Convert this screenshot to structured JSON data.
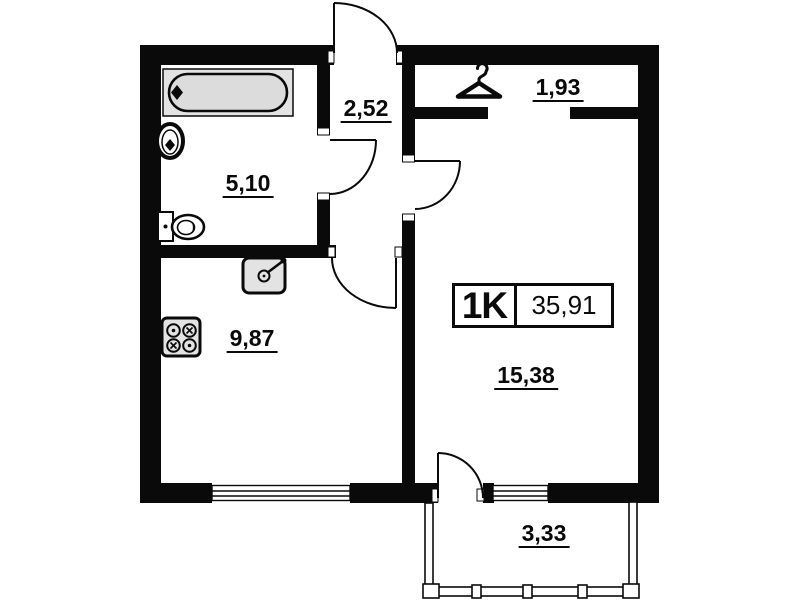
{
  "unit": {
    "type_label": "1K",
    "total_area": "35,91"
  },
  "areas": {
    "bathroom": "5,10",
    "hallway": "2,52",
    "wardrobe": "1,93",
    "kitchen": "9,87",
    "living_room": "15,38",
    "balcony": "3,33"
  },
  "icons": {
    "wardrobe": "hanger-icon",
    "bathroom": [
      "bathtub-icon",
      "washbasin-icon",
      "toilet-icon"
    ],
    "kitchen": [
      "stove-icon",
      "kitchen-sink-icon"
    ]
  },
  "colors": {
    "walls": "#0a0a0a",
    "background": "#ffffff",
    "fixture_fill": "#e3e3e3",
    "text": "#0a0a0a"
  }
}
